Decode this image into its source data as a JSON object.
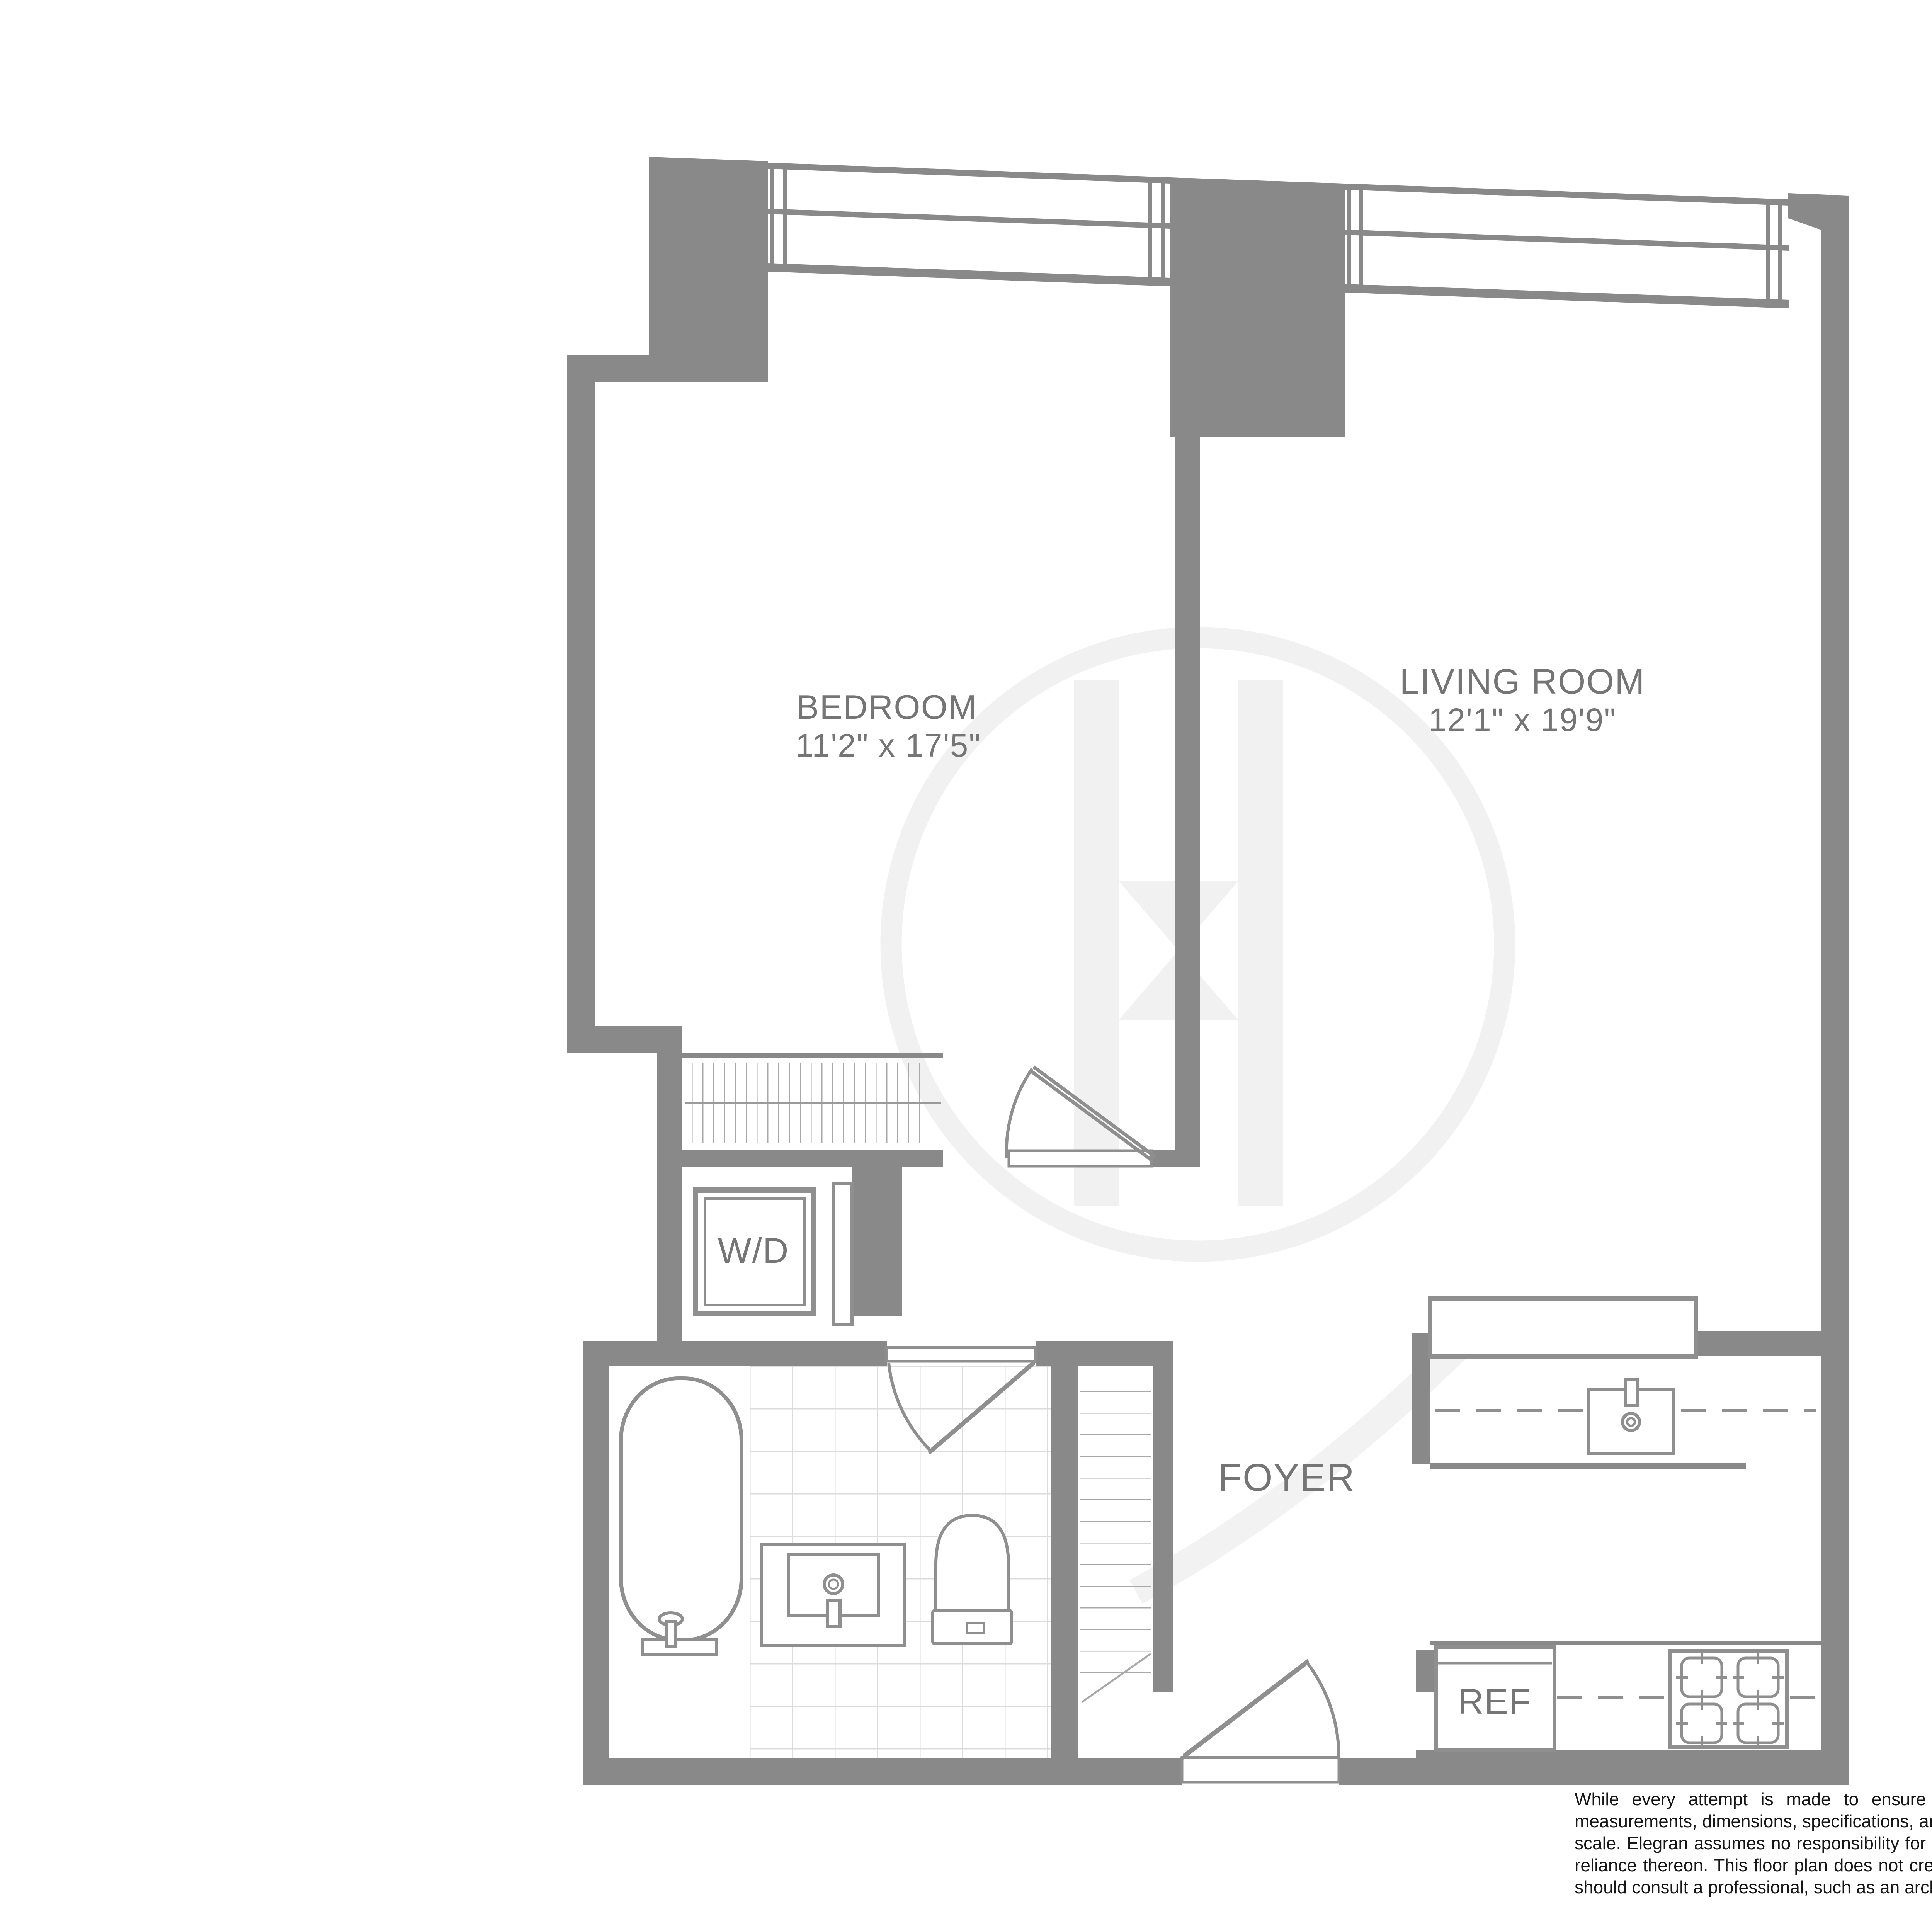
{
  "rooms": {
    "bedroom": {
      "name": "BEDROOM",
      "dimensions": "11'2\" x 17'5\""
    },
    "living_room": {
      "name": "LIVING ROOM",
      "dimensions": "12'1\" x 19'9\""
    },
    "foyer": {
      "name": "FOYER"
    }
  },
  "appliances": {
    "washer_dryer": "W/D",
    "refrigerator": "REF"
  },
  "disclaimer": "While every attempt is made to ensure accuracy, this floorplan is for guidance only. The measurements, dimensions, specifications, and other data shown are approximate and may not be to scale. Elegran assumes no responsibility for the accuracy of this floor plan or for any action taken in reliance thereon. This floor plan does not create any representation, warranty or contract. All parties should consult a professional, such as an archaitect, to verify the information contained herein.",
  "colors": {
    "wall": "#898989",
    "fixture_line": "#8f8f8f",
    "label_text": "#757575",
    "tile_line": "#dcdcdc",
    "watermark": "#f1f1f1",
    "disclaimer_text": "#161616",
    "background": "#ffffff"
  }
}
